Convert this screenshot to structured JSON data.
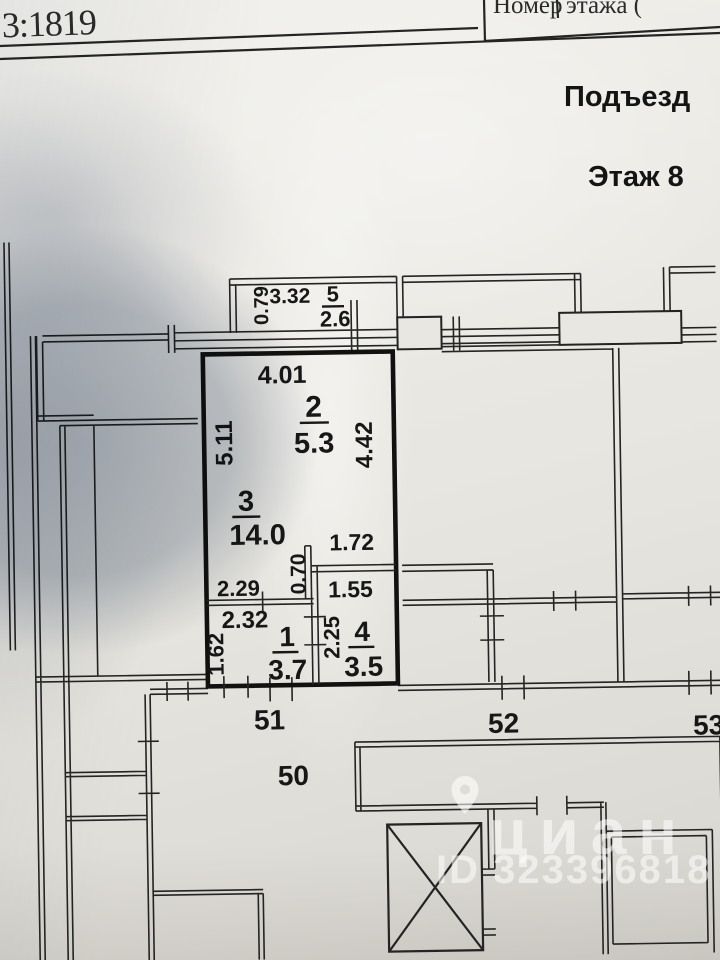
{
  "header": {
    "cadastral": "3:1819",
    "table_cell_1": "Номер",
    "table_cell_2": "этажа (",
    "entrance": "Подъезд",
    "floor": "Этаж 8"
  },
  "plan": {
    "balcony": {
      "num": "5",
      "area": "2.6",
      "depth": "0.79",
      "width": "3.32"
    },
    "kitchen": {
      "num": "2",
      "area": "5.3",
      "width": "4.01",
      "left": "5.11",
      "right": "4.42"
    },
    "living": {
      "num": "3",
      "area": "14.0"
    },
    "hall": {
      "num": "1",
      "area": "3.7",
      "top": "2.29",
      "width": "2.32",
      "left": "1.62",
      "passage": "0.70"
    },
    "bath": {
      "num": "4",
      "area": "3.5",
      "niche": "1.72",
      "width": "1.55",
      "height": "2.25"
    },
    "units": {
      "u50": "50",
      "u51": "51",
      "u52": "52",
      "u53": "53"
    }
  },
  "watermark": {
    "brand": "циан",
    "id": "ID 323396818"
  }
}
